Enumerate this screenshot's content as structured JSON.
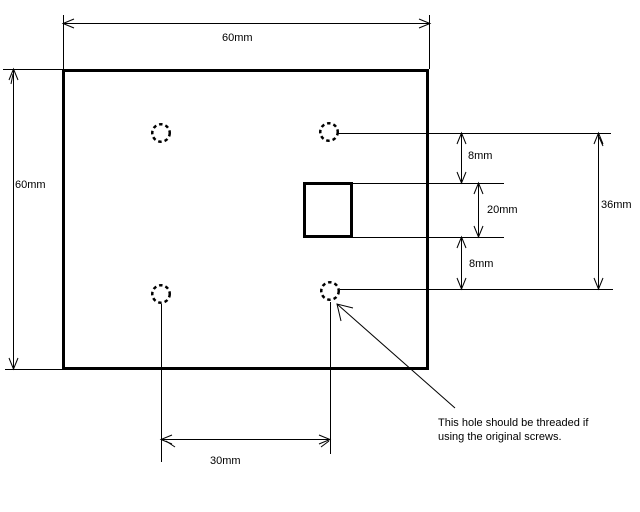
{
  "drawing": {
    "type": "mechanical-plate-drawing",
    "background_color": "#ffffff",
    "line_color": "#000000",
    "text_color": "#000000",
    "plate": {
      "width_label": "60mm",
      "height_label": "60mm",
      "hole_count": 4,
      "hole_style": "dashed-circle"
    }
  },
  "labels": {
    "top_width": "60mm",
    "left_height": "60mm",
    "hole_to_slot_top_gap": "8mm",
    "slot_height": "20mm",
    "slot_to_hole_bottom_gap": "8mm",
    "holes_vertical_span": "36mm",
    "holes_horizontal_span": "30mm"
  },
  "note": {
    "line1": "This hole should be threaded if",
    "line2": "using the original screws."
  }
}
